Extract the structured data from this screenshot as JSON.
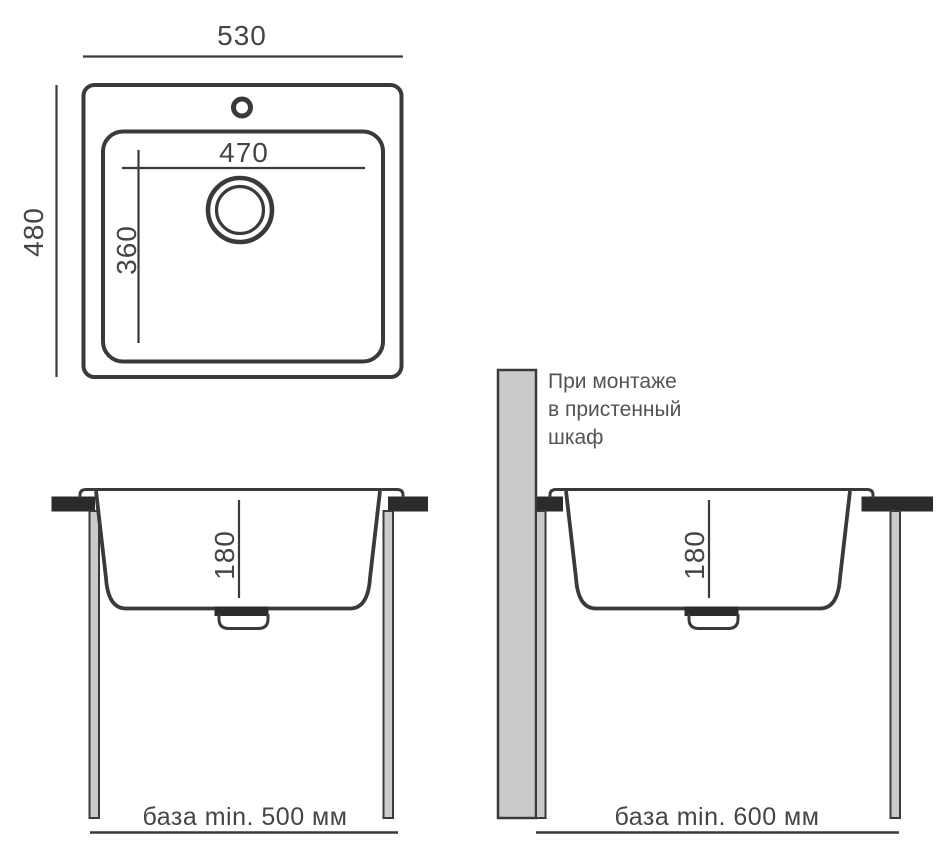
{
  "diagram": {
    "top_view": {
      "outer_width_label": "530",
      "outer_depth_label": "480",
      "bowl_width_label": "470",
      "bowl_depth_label": "360"
    },
    "side_view_standard": {
      "bowl_height_label": "180",
      "base_label": "база min. 500 мм"
    },
    "side_view_wall_cabinet": {
      "bowl_height_label": "180",
      "base_label": "база min. 600 мм",
      "note_line1": "При монтаже",
      "note_line2": "в пристенный",
      "note_line3": "шкаф"
    },
    "colors": {
      "line": "#3a3a3a",
      "text": "#454545",
      "note_text": "#515457",
      "fill_dark": "#2b2b2b",
      "fill_gray": "#c9cbc9",
      "background": "#ffffff"
    }
  }
}
